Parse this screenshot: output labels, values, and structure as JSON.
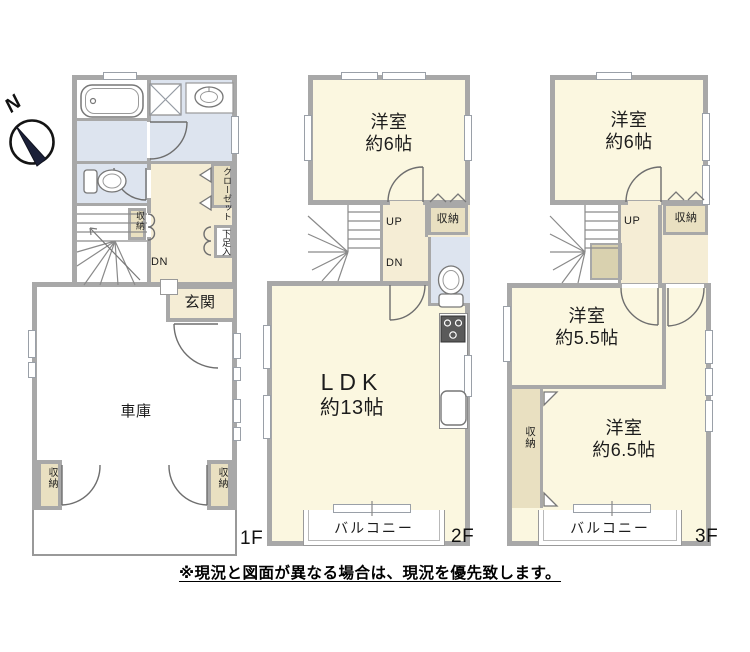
{
  "colors": {
    "room": "#FBF7E0",
    "hall": "#F5EDD5",
    "wet": "#DDE4EF",
    "storage": "#E9E0C1",
    "storage_dark": "#D9D1AF",
    "wall": "#A8A8A8",
    "balcony_wall": "#ABABAB"
  },
  "compass": {
    "north": "N"
  },
  "floor1": {
    "label": "1F",
    "closet_small": "収納",
    "closet": "クローゼット",
    "shoe_cabinet": "下足入",
    "down": "DN",
    "entrance": "玄関",
    "garage": "車庫",
    "storage_left": "収納",
    "storage_right": "収納"
  },
  "floor2": {
    "label": "2F",
    "room_top": "洋室",
    "room_top_size": "約6帖",
    "up": "UP",
    "down": "DN",
    "storage": "収納",
    "ldk": "LDK",
    "ldk_size": "約13帖",
    "balcony": "バルコニー"
  },
  "floor3": {
    "label": "3F",
    "room_top": "洋室",
    "room_top_size": "約6帖",
    "up": "UP",
    "storage_top": "収納",
    "room_mid": "洋室",
    "room_mid_size": "約5.5帖",
    "storage_left": "収納",
    "room_bottom": "洋室",
    "room_bottom_size": "約6.5帖",
    "balcony": "バルコニー"
  },
  "disclaimer": "※現況と図面が異なる場合は、現況を優先致します。"
}
